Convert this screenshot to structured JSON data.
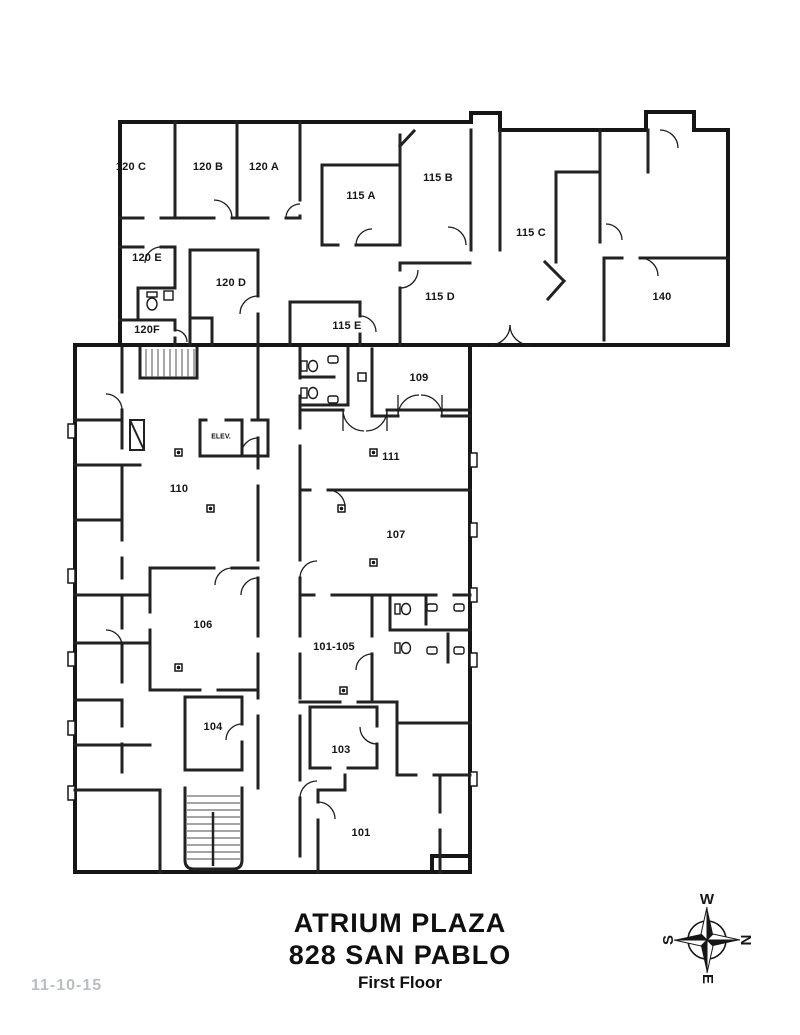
{
  "title": {
    "building": "ATRIUM PLAZA",
    "address": "828 SAN PABLO",
    "floor": "First Floor"
  },
  "annotations": {
    "date": "11-10-15"
  },
  "compass": {
    "top": "W",
    "right": "N",
    "bottom": "E",
    "left": "S"
  },
  "rooms": [
    {
      "id": "120-c",
      "label": "120 C"
    },
    {
      "id": "120-b",
      "label": "120 B"
    },
    {
      "id": "120-a",
      "label": "120 A"
    },
    {
      "id": "115-a",
      "label": "115 A"
    },
    {
      "id": "115-b",
      "label": "115 B"
    },
    {
      "id": "115-c",
      "label": "115 C"
    },
    {
      "id": "120-e",
      "label": "120 E"
    },
    {
      "id": "120-d",
      "label": "120 D"
    },
    {
      "id": "115-d",
      "label": "115 D"
    },
    {
      "id": "140",
      "label": "140"
    },
    {
      "id": "120-f",
      "label": "120F"
    },
    {
      "id": "115-e",
      "label": "115 E"
    },
    {
      "id": "109",
      "label": "109"
    },
    {
      "id": "111",
      "label": "111"
    },
    {
      "id": "110",
      "label": "110"
    },
    {
      "id": "107",
      "label": "107"
    },
    {
      "id": "106",
      "label": "106"
    },
    {
      "id": "101-105",
      "label": "101-105"
    },
    {
      "id": "104",
      "label": "104"
    },
    {
      "id": "103",
      "label": "103"
    },
    {
      "id": "101",
      "label": "101"
    },
    {
      "id": "elev",
      "label": "ELEV."
    }
  ],
  "colors": {
    "walls": "#1a1a1a",
    "secondary_walls": "#6f6f6f",
    "date_text": "#b9bec0",
    "background": "#ffffff",
    "label_text": "#161616"
  }
}
